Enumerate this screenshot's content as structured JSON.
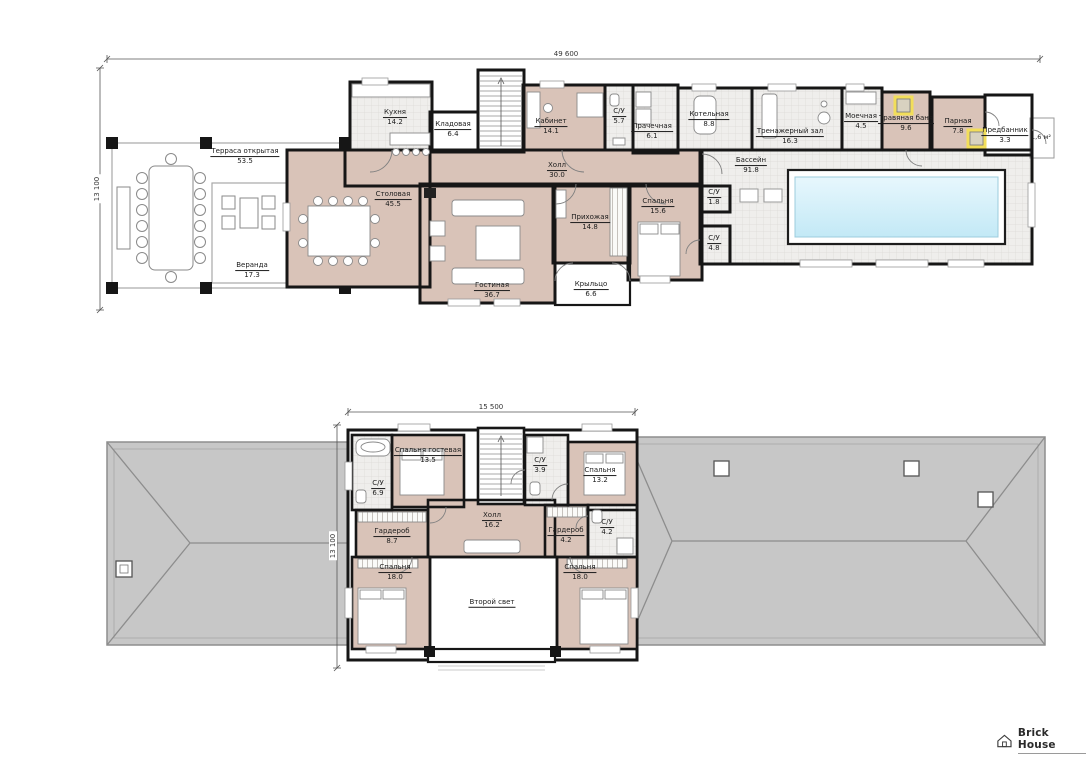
{
  "logo": {
    "text": "Brick House"
  },
  "colors": {
    "wall_black": "#161616",
    "floor_beige": "#d9c3b8",
    "tile_gray": "#efeeec",
    "pool_water": "#cdecf7",
    "roof_gray": "#c7c7c7",
    "stove_yellow": "#f2de5a"
  },
  "dimensions": {
    "floor1_width": "49 600",
    "floor1_height": "13 100",
    "floor2_width": "15 500",
    "floor2_height": "13 100"
  },
  "floor1": {
    "note_area": "1,6 м²",
    "rooms": {
      "terrace": {
        "name": "Терраса открытая",
        "area": "53.5"
      },
      "veranda": {
        "name": "Веранда",
        "area": "17.3"
      },
      "kitchen": {
        "name": "Кухня",
        "area": "14.2"
      },
      "pantry": {
        "name": "Кладовая",
        "area": "6.4"
      },
      "dining": {
        "name": "Столовая",
        "area": "45.5"
      },
      "office": {
        "name": "Кабинет",
        "area": "14.1"
      },
      "wc57": {
        "name": "С/У",
        "area": "5.7"
      },
      "laundry": {
        "name": "Прачечная",
        "area": "6.1"
      },
      "boiler": {
        "name": "Котельная",
        "area": "8.8"
      },
      "hall": {
        "name": "Холл",
        "area": "30.0"
      },
      "gym": {
        "name": "Тренажерный зал",
        "area": "16.3"
      },
      "washroom": {
        "name": "Моечная",
        "area": "4.5"
      },
      "herbal": {
        "name": "Травяная баня",
        "area": "9.6"
      },
      "steam": {
        "name": "Парная",
        "area": "7.8"
      },
      "ante": {
        "name": "Предбанник",
        "area": "3.3"
      },
      "pool": {
        "name": "Бассейн",
        "area": "91.8"
      },
      "wc18": {
        "name": "С/У",
        "area": "1.8"
      },
      "entry": {
        "name": "Прихожая",
        "area": "14.8"
      },
      "bedroom": {
        "name": "Спальня",
        "area": "15.6"
      },
      "wc48": {
        "name": "С/У",
        "area": "4.8"
      },
      "living": {
        "name": "Гостиная",
        "area": "36.7"
      },
      "porch": {
        "name": "Крыльцо",
        "area": "6.6"
      }
    }
  },
  "floor2": {
    "rooms": {
      "guest": {
        "name": "Спальня гостевая",
        "area": "13.5"
      },
      "wc69": {
        "name": "С/У",
        "area": "6.9"
      },
      "wc39": {
        "name": "С/У",
        "area": "3.9"
      },
      "bed132": {
        "name": "Спальня",
        "area": "13.2"
      },
      "hall": {
        "name": "Холл",
        "area": "16.2"
      },
      "ward87": {
        "name": "Гардероб",
        "area": "8.7"
      },
      "ward42": {
        "name": "Гардероб",
        "area": "4.2"
      },
      "wc42": {
        "name": "С/У",
        "area": "4.2"
      },
      "bed18l": {
        "name": "Спальня",
        "area": "18.0"
      },
      "bed18r": {
        "name": "Спальня",
        "area": "18.0"
      },
      "void": {
        "name": "Второй свет"
      }
    }
  }
}
